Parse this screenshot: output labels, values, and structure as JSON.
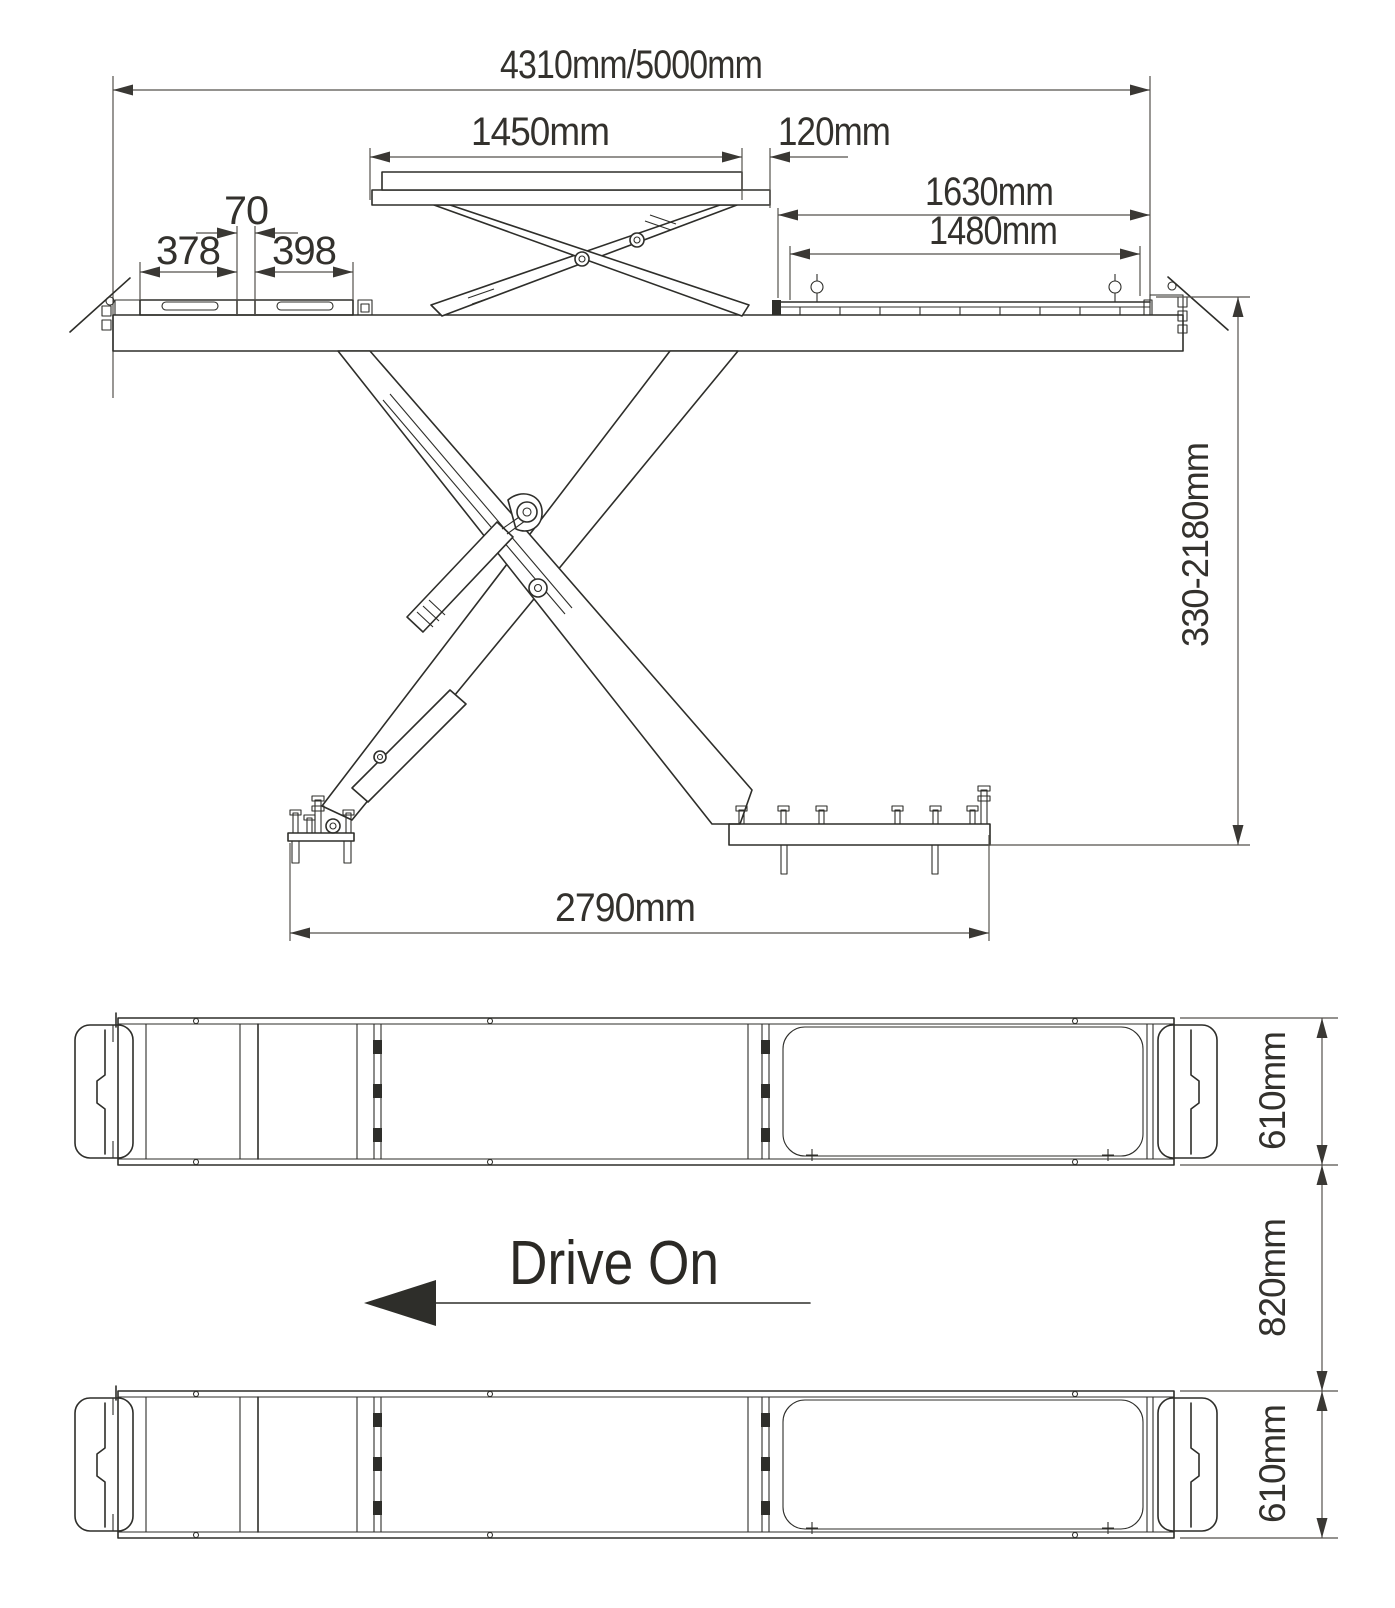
{
  "side_view": {
    "overall_length": "4310mm/5000mm",
    "jack_platform_length": "1450mm",
    "jack_offset": "120mm",
    "front_plate_gap": "70",
    "front_plate_left": "378",
    "front_plate_right": "398",
    "extension_overall": "1630mm",
    "extension_inner": "1480mm",
    "lift_height_range": "330-2180mm",
    "base_span": "2790mm"
  },
  "plan_view": {
    "drive_on": "Drive On",
    "runway_width_front": "610mm",
    "runway_gap": "820mm",
    "runway_width_rear": "610mm"
  },
  "colors": {
    "line": "#2e2e2a",
    "dimension": "#55524c",
    "text": "#33312d",
    "background": "#ffffff"
  }
}
